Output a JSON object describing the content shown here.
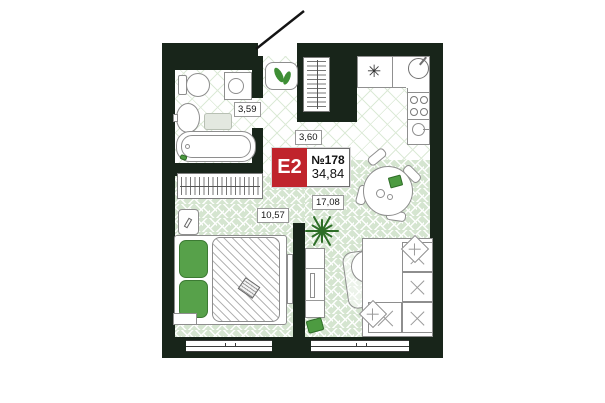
{
  "unit": {
    "type_label": "E2",
    "number": "№178",
    "total_area": "34,84"
  },
  "rooms": {
    "bathroom_area": "3,59",
    "hallway_area": "3,60",
    "bedroom_area": "10,57",
    "living_area": "17,08"
  },
  "icons": {
    "hob_glyph": "✳"
  },
  "colors": {
    "wall": "#18251a",
    "badge_red": "#c0242c",
    "floor_green": "#d5e5d0",
    "floor_hatch_line": "#dcead7",
    "accent_green": "#4d9b41"
  }
}
